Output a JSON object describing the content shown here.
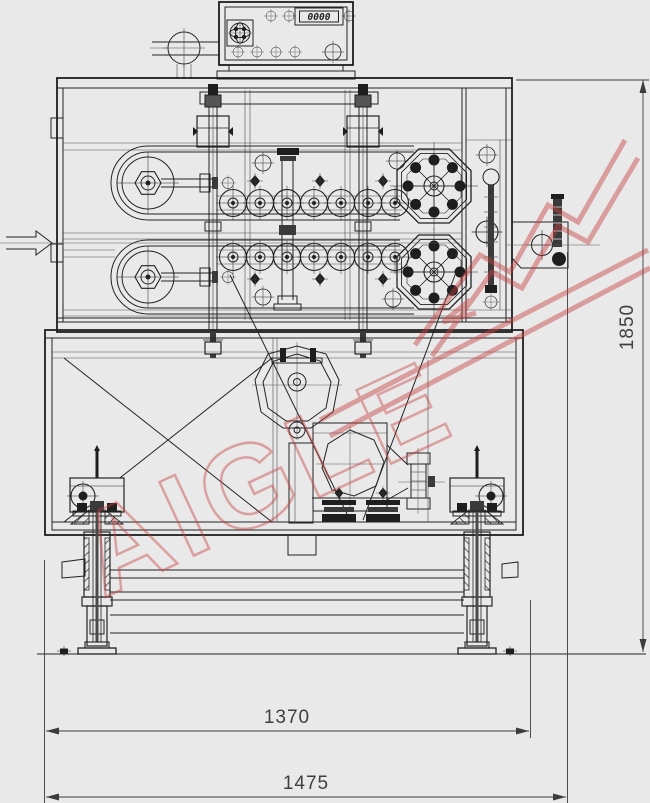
{
  "drawing": {
    "control_panel": {
      "display_value": "0000"
    },
    "dimensions": {
      "overall_height": "1850",
      "frame_width": "1370",
      "overall_width": "1475"
    },
    "watermark": {
      "text": "AIGLE"
    },
    "colors": {
      "background": "#e9e9e9",
      "line": "#232323",
      "watermark_red": "#c84040"
    }
  }
}
